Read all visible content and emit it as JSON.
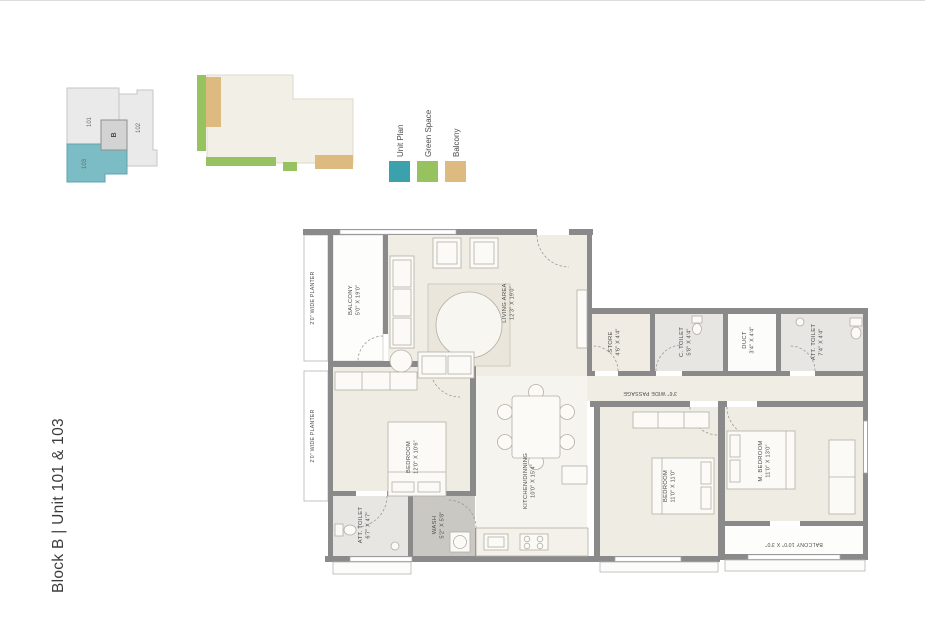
{
  "page": {
    "title": "Block B | Unit 101 & 103"
  },
  "key_plan": {
    "block": "B",
    "units": [
      "101",
      "102",
      "103"
    ],
    "highlight_color": "#7bbcc5"
  },
  "legend": {
    "items": [
      {
        "label": "Unit Plan",
        "color": "#3ba1ad"
      },
      {
        "label": "Green Space",
        "color": "#96c35f"
      },
      {
        "label": "Balcony",
        "color": "#dcba80"
      }
    ]
  },
  "floor_plan": {
    "wall_color": "#8a8a8a",
    "planter_label": "2'0\" WIDE PLANTER",
    "passage_label": "3'6\" WIDE PASSAGE",
    "balcony_bottom_label": "BALCONY 10'0\" X 3'0\"",
    "rooms": [
      {
        "name": "BALCONY",
        "dims": "5'0\" X 19'0\""
      },
      {
        "name": "LIVING AREA",
        "dims": "12'3\" X 19'0\""
      },
      {
        "name": "STORE",
        "dims": "4'6\" X 4'4\""
      },
      {
        "name": "C. TOILET",
        "dims": "5'8\" X 4'4\""
      },
      {
        "name": "DUCT",
        "dims": "3'4\" X 4'4\""
      },
      {
        "name": "ATT. TOILET",
        "dims": "7'4\" X 4'4\""
      },
      {
        "name": "BEDROOM",
        "dims": "12'0\" X 10'6\""
      },
      {
        "name": "KITCHEN/DINNING",
        "dims": "10'0\" X 15'4\""
      },
      {
        "name": "BEDROOM",
        "dims": "11'0\" X 11'0\""
      },
      {
        "name": "M. BEDROOM",
        "dims": "11'0\" X 13'0\""
      },
      {
        "name": "ATT. TOILET",
        "dims": "6'7\" X 4'7\""
      },
      {
        "name": "WASH",
        "dims": "5'2\" X 5'8\""
      }
    ]
  }
}
